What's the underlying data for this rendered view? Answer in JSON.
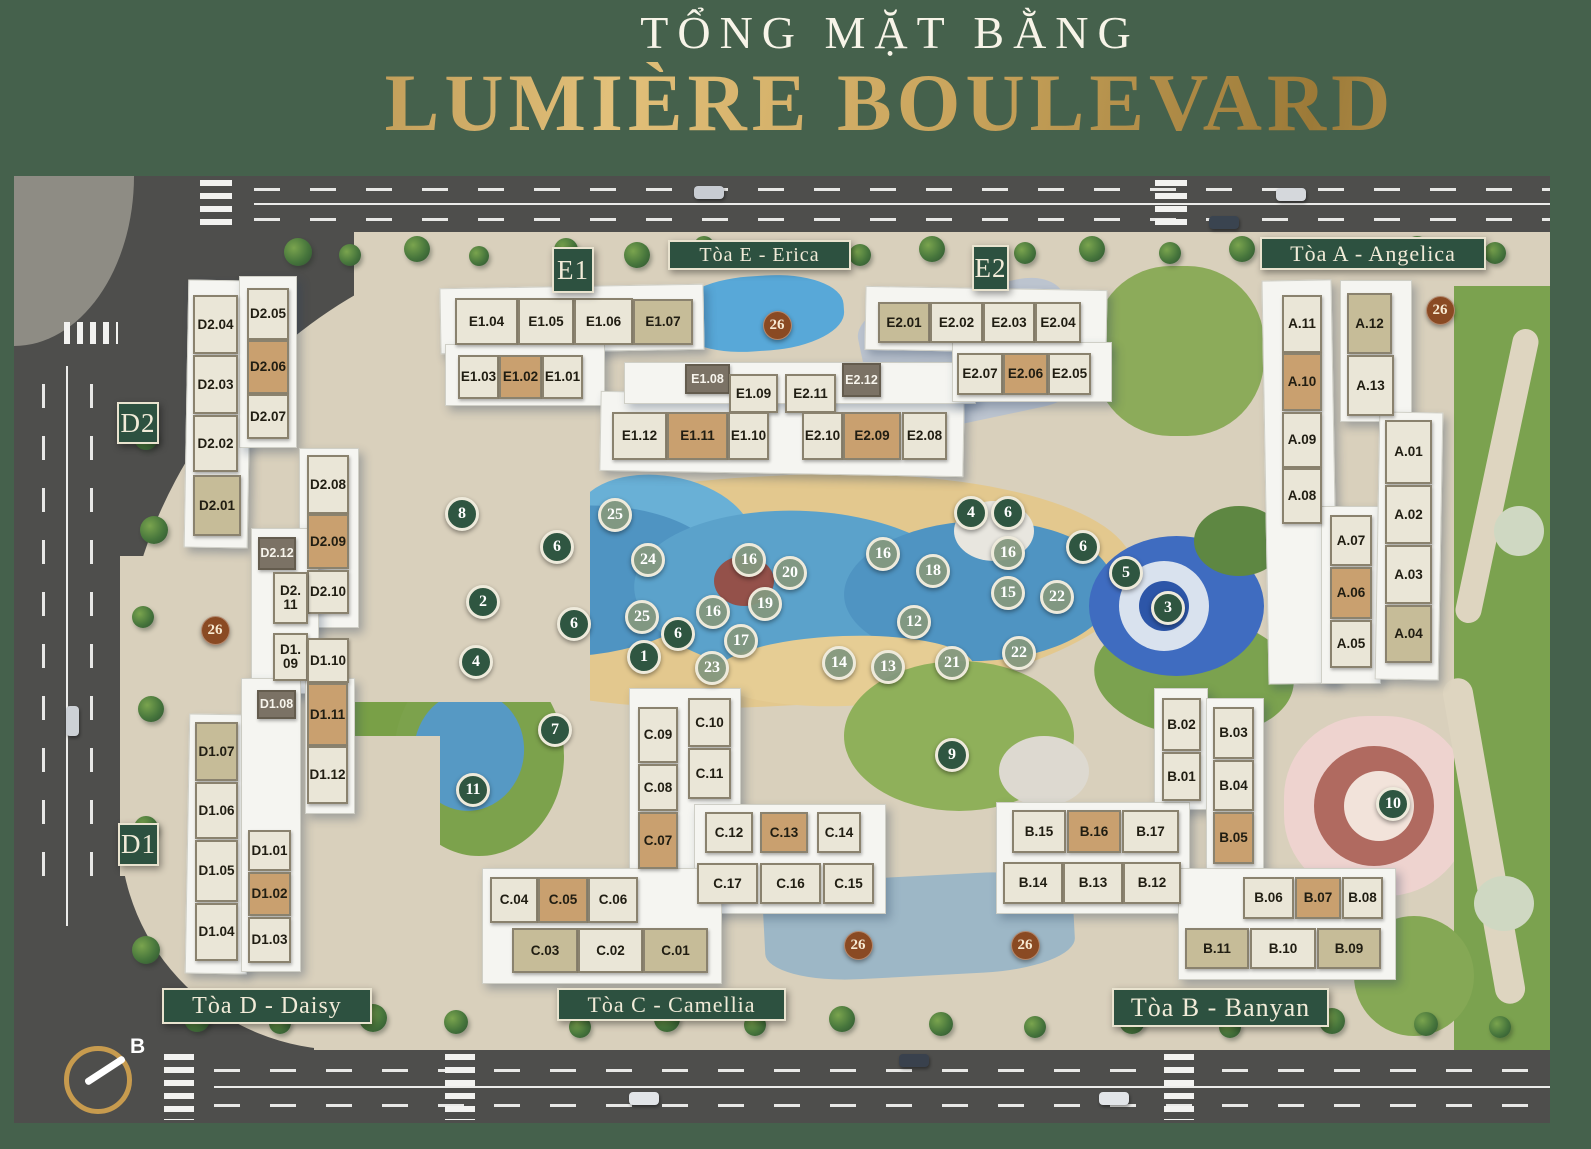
{
  "title": {
    "subtitle": "TỔNG MẶT BẰNG",
    "main": "LUMIÈRE BOULEVARD"
  },
  "colors": {
    "page_bg": "#45614c",
    "banner_green": "#2d5140",
    "gold": "#c9a45c",
    "unit_cream": "#eae6d7",
    "unit_tan": "#c9a06f",
    "unit_khaki": "#c6bc98",
    "unit_dark": "#7b7265",
    "marker_dark_green": "#2f5641",
    "marker_sage": "#84987e",
    "marker_brown": "#8a4a23"
  },
  "compass": {
    "label": "B"
  },
  "map": {
    "banners": [
      {
        "id": "banner-toa-e",
        "label": "Tòa E - Erica",
        "x": 668,
        "y": 240,
        "w": 183,
        "h": 30
      },
      {
        "id": "banner-toa-a",
        "label": "Tòa A - Angelica",
        "x": 1260,
        "y": 237,
        "w": 226,
        "h": 33
      },
      {
        "id": "banner-toa-d",
        "label": "Tòa D - Daisy",
        "x": 162,
        "y": 988,
        "w": 210,
        "h": 36
      },
      {
        "id": "banner-toa-c",
        "label": "Tòa C - Camellia",
        "x": 557,
        "y": 988,
        "w": 229,
        "h": 33
      },
      {
        "id": "banner-toa-b",
        "label": "Tòa B - Banyan",
        "x": 1112,
        "y": 988,
        "w": 217,
        "h": 39
      }
    ],
    "block_labels": [
      {
        "id": "block-label-e1",
        "label": "E1",
        "x": 552,
        "y": 247,
        "w": 42,
        "h": 46
      },
      {
        "id": "block-label-e2",
        "label": "E2",
        "x": 972,
        "y": 245,
        "w": 37,
        "h": 46
      },
      {
        "id": "block-label-d2",
        "label": "D2",
        "x": 117,
        "y": 402,
        "w": 42,
        "h": 42
      },
      {
        "id": "block-label-d1",
        "label": "D1",
        "x": 118,
        "y": 823,
        "w": 41,
        "h": 43
      }
    ],
    "units": [
      {
        "l": "E1.04",
        "x": 455,
        "y": 298,
        "w": 63,
        "h": 47,
        "t": "cream"
      },
      {
        "l": "E1.05",
        "x": 518,
        "y": 298,
        "w": 56,
        "h": 47,
        "t": "cream"
      },
      {
        "l": "E1.06",
        "x": 574,
        "y": 298,
        "w": 59,
        "h": 47,
        "t": "cream"
      },
      {
        "l": "E1.07",
        "x": 633,
        "y": 299,
        "w": 60,
        "h": 46,
        "t": "khaki"
      },
      {
        "l": "E1.03",
        "x": 458,
        "y": 355,
        "w": 41,
        "h": 44,
        "t": "cream"
      },
      {
        "l": "E1.02",
        "x": 499,
        "y": 355,
        "w": 43,
        "h": 44,
        "t": "tan"
      },
      {
        "l": "E1.01",
        "x": 542,
        "y": 355,
        "w": 41,
        "h": 44,
        "t": "cream"
      },
      {
        "l": "E1.08",
        "x": 685,
        "y": 364,
        "w": 45,
        "h": 30,
        "t": "dark"
      },
      {
        "l": "E1.09",
        "x": 729,
        "y": 374,
        "w": 49,
        "h": 39,
        "t": "cream"
      },
      {
        "l": "E2.11",
        "x": 785,
        "y": 374,
        "w": 51,
        "h": 39,
        "t": "cream"
      },
      {
        "l": "E2.12",
        "x": 842,
        "y": 363,
        "w": 39,
        "h": 34,
        "t": "dark"
      },
      {
        "l": "E1.12",
        "x": 612,
        "y": 412,
        "w": 55,
        "h": 48,
        "t": "cream"
      },
      {
        "l": "E1.11",
        "x": 667,
        "y": 412,
        "w": 61,
        "h": 48,
        "t": "tan"
      },
      {
        "l": "E1.10",
        "x": 728,
        "y": 412,
        "w": 41,
        "h": 48,
        "t": "cream"
      },
      {
        "l": "E2.10",
        "x": 802,
        "y": 412,
        "w": 41,
        "h": 48,
        "t": "cream"
      },
      {
        "l": "E2.09",
        "x": 843,
        "y": 412,
        "w": 58,
        "h": 48,
        "t": "tan"
      },
      {
        "l": "E2.08",
        "x": 902,
        "y": 412,
        "w": 45,
        "h": 48,
        "t": "cream"
      },
      {
        "l": "E2.01",
        "x": 878,
        "y": 302,
        "w": 52,
        "h": 41,
        "t": "khaki"
      },
      {
        "l": "E2.02",
        "x": 930,
        "y": 302,
        "w": 53,
        "h": 41,
        "t": "cream"
      },
      {
        "l": "E2.03",
        "x": 983,
        "y": 302,
        "w": 52,
        "h": 41,
        "t": "cream"
      },
      {
        "l": "E2.04",
        "x": 1035,
        "y": 302,
        "w": 46,
        "h": 41,
        "t": "cream"
      },
      {
        "l": "E2.07",
        "x": 957,
        "y": 353,
        "w": 46,
        "h": 42,
        "t": "cream"
      },
      {
        "l": "E2.06",
        "x": 1003,
        "y": 353,
        "w": 45,
        "h": 42,
        "t": "tan"
      },
      {
        "l": "E2.05",
        "x": 1048,
        "y": 353,
        "w": 43,
        "h": 42,
        "t": "cream"
      },
      {
        "l": "A.11",
        "x": 1282,
        "y": 295,
        "w": 40,
        "h": 58,
        "t": "cream"
      },
      {
        "l": "A.12",
        "x": 1347,
        "y": 293,
        "w": 45,
        "h": 61,
        "t": "khaki"
      },
      {
        "l": "A.10",
        "x": 1282,
        "y": 353,
        "w": 40,
        "h": 58,
        "t": "tan"
      },
      {
        "l": "A.13",
        "x": 1347,
        "y": 355,
        "w": 47,
        "h": 61,
        "t": "cream"
      },
      {
        "l": "A.09",
        "x": 1282,
        "y": 412,
        "w": 40,
        "h": 56,
        "t": "cream"
      },
      {
        "l": "A.08",
        "x": 1282,
        "y": 468,
        "w": 40,
        "h": 56,
        "t": "cream"
      },
      {
        "l": "A.01",
        "x": 1385,
        "y": 420,
        "w": 47,
        "h": 64,
        "t": "cream"
      },
      {
        "l": "A.02",
        "x": 1385,
        "y": 485,
        "w": 47,
        "h": 59,
        "t": "cream"
      },
      {
        "l": "A.03",
        "x": 1385,
        "y": 545,
        "w": 47,
        "h": 59,
        "t": "cream"
      },
      {
        "l": "A.04",
        "x": 1385,
        "y": 605,
        "w": 47,
        "h": 58,
        "t": "khaki"
      },
      {
        "l": "A.07",
        "x": 1330,
        "y": 515,
        "w": 42,
        "h": 51,
        "t": "cream"
      },
      {
        "l": "A.06",
        "x": 1330,
        "y": 567,
        "w": 42,
        "h": 52,
        "t": "tan"
      },
      {
        "l": "A.05",
        "x": 1330,
        "y": 620,
        "w": 42,
        "h": 48,
        "t": "cream"
      },
      {
        "l": "D2.04",
        "x": 193,
        "y": 295,
        "w": 45,
        "h": 59,
        "t": "cream"
      },
      {
        "l": "D2.03",
        "x": 193,
        "y": 355,
        "w": 45,
        "h": 59,
        "t": "cream"
      },
      {
        "l": "D2.02",
        "x": 193,
        "y": 415,
        "w": 45,
        "h": 57,
        "t": "cream"
      },
      {
        "l": "D2.01",
        "x": 193,
        "y": 475,
        "w": 48,
        "h": 61,
        "t": "khaki"
      },
      {
        "l": "D2.05",
        "x": 247,
        "y": 288,
        "w": 42,
        "h": 52,
        "t": "cream"
      },
      {
        "l": "D2.06",
        "x": 247,
        "y": 340,
        "w": 42,
        "h": 54,
        "t": "tan"
      },
      {
        "l": "D2.07",
        "x": 247,
        "y": 394,
        "w": 42,
        "h": 45,
        "t": "cream"
      },
      {
        "l": "D2.08",
        "x": 307,
        "y": 455,
        "w": 42,
        "h": 59,
        "t": "cream"
      },
      {
        "l": "D2.09",
        "x": 307,
        "y": 514,
        "w": 42,
        "h": 55,
        "t": "tan"
      },
      {
        "l": "D2.10",
        "x": 307,
        "y": 570,
        "w": 42,
        "h": 44,
        "t": "cream"
      },
      {
        "l": "D2.12",
        "x": 258,
        "y": 537,
        "w": 38,
        "h": 33,
        "t": "dark"
      },
      {
        "l": "D2.11",
        "x": 273,
        "y": 572,
        "w": 35,
        "h": 52,
        "t": "cream",
        "lines": [
          "D2.",
          "11"
        ]
      },
      {
        "l": "D1.09",
        "x": 273,
        "y": 633,
        "w": 35,
        "h": 48,
        "t": "cream",
        "lines": [
          "D1.",
          "09"
        ]
      },
      {
        "l": "D1.10",
        "x": 307,
        "y": 638,
        "w": 42,
        "h": 45,
        "t": "cream"
      },
      {
        "l": "D1.08",
        "x": 257,
        "y": 690,
        "w": 39,
        "h": 29,
        "t": "dark"
      },
      {
        "l": "D1.11",
        "x": 307,
        "y": 683,
        "w": 41,
        "h": 63,
        "t": "tan"
      },
      {
        "l": "D1.12",
        "x": 307,
        "y": 746,
        "w": 41,
        "h": 58,
        "t": "cream"
      },
      {
        "l": "D1.07",
        "x": 195,
        "y": 722,
        "w": 43,
        "h": 59,
        "t": "khaki"
      },
      {
        "l": "D1.06",
        "x": 195,
        "y": 782,
        "w": 43,
        "h": 57,
        "t": "cream"
      },
      {
        "l": "D1.05",
        "x": 195,
        "y": 840,
        "w": 43,
        "h": 62,
        "t": "cream"
      },
      {
        "l": "D1.04",
        "x": 195,
        "y": 903,
        "w": 43,
        "h": 58,
        "t": "cream"
      },
      {
        "l": "D1.01",
        "x": 248,
        "y": 830,
        "w": 43,
        "h": 41,
        "t": "cream"
      },
      {
        "l": "D1.02",
        "x": 248,
        "y": 872,
        "w": 43,
        "h": 44,
        "t": "tan"
      },
      {
        "l": "D1.03",
        "x": 248,
        "y": 917,
        "w": 43,
        "h": 46,
        "t": "cream"
      },
      {
        "l": "C.09",
        "x": 638,
        "y": 707,
        "w": 40,
        "h": 56,
        "t": "cream"
      },
      {
        "l": "C.08",
        "x": 638,
        "y": 764,
        "w": 40,
        "h": 47,
        "t": "cream"
      },
      {
        "l": "C.07",
        "x": 638,
        "y": 812,
        "w": 40,
        "h": 57,
        "t": "tan"
      },
      {
        "l": "C.10",
        "x": 688,
        "y": 698,
        "w": 43,
        "h": 49,
        "t": "cream"
      },
      {
        "l": "C.11",
        "x": 688,
        "y": 748,
        "w": 43,
        "h": 51,
        "t": "cream"
      },
      {
        "l": "C.12",
        "x": 705,
        "y": 812,
        "w": 48,
        "h": 41,
        "t": "cream"
      },
      {
        "l": "C.13",
        "x": 760,
        "y": 812,
        "w": 48,
        "h": 41,
        "t": "tan"
      },
      {
        "l": "C.14",
        "x": 817,
        "y": 812,
        "w": 44,
        "h": 41,
        "t": "cream"
      },
      {
        "l": "C.17",
        "x": 697,
        "y": 863,
        "w": 61,
        "h": 41,
        "t": "cream"
      },
      {
        "l": "C.16",
        "x": 760,
        "y": 863,
        "w": 61,
        "h": 41,
        "t": "cream"
      },
      {
        "l": "C.15",
        "x": 823,
        "y": 863,
        "w": 51,
        "h": 41,
        "t": "cream"
      },
      {
        "l": "C.04",
        "x": 490,
        "y": 877,
        "w": 48,
        "h": 46,
        "t": "cream"
      },
      {
        "l": "C.05",
        "x": 538,
        "y": 877,
        "w": 50,
        "h": 46,
        "t": "tan"
      },
      {
        "l": "C.06",
        "x": 588,
        "y": 877,
        "w": 50,
        "h": 46,
        "t": "cream"
      },
      {
        "l": "C.03",
        "x": 512,
        "y": 928,
        "w": 66,
        "h": 45,
        "t": "khaki"
      },
      {
        "l": "C.02",
        "x": 578,
        "y": 928,
        "w": 65,
        "h": 45,
        "t": "cream"
      },
      {
        "l": "C.01",
        "x": 643,
        "y": 928,
        "w": 65,
        "h": 45,
        "t": "khaki"
      },
      {
        "l": "B.02",
        "x": 1162,
        "y": 698,
        "w": 39,
        "h": 53,
        "t": "cream"
      },
      {
        "l": "B.01",
        "x": 1162,
        "y": 752,
        "w": 39,
        "h": 49,
        "t": "cream"
      },
      {
        "l": "B.03",
        "x": 1213,
        "y": 707,
        "w": 41,
        "h": 52,
        "t": "cream"
      },
      {
        "l": "B.04",
        "x": 1213,
        "y": 760,
        "w": 41,
        "h": 51,
        "t": "cream"
      },
      {
        "l": "B.05",
        "x": 1213,
        "y": 812,
        "w": 41,
        "h": 52,
        "t": "tan"
      },
      {
        "l": "B.15",
        "x": 1012,
        "y": 810,
        "w": 54,
        "h": 43,
        "t": "cream"
      },
      {
        "l": "B.16",
        "x": 1067,
        "y": 810,
        "w": 54,
        "h": 43,
        "t": "tan"
      },
      {
        "l": "B.17",
        "x": 1122,
        "y": 810,
        "w": 57,
        "h": 43,
        "t": "cream"
      },
      {
        "l": "B.14",
        "x": 1003,
        "y": 862,
        "w": 60,
        "h": 42,
        "t": "cream"
      },
      {
        "l": "B.13",
        "x": 1063,
        "y": 862,
        "w": 60,
        "h": 42,
        "t": "cream"
      },
      {
        "l": "B.12",
        "x": 1123,
        "y": 862,
        "w": 58,
        "h": 42,
        "t": "cream"
      },
      {
        "l": "B.06",
        "x": 1243,
        "y": 877,
        "w": 51,
        "h": 42,
        "t": "cream"
      },
      {
        "l": "B.07",
        "x": 1295,
        "y": 877,
        "w": 46,
        "h": 42,
        "t": "tan"
      },
      {
        "l": "B.08",
        "x": 1342,
        "y": 877,
        "w": 41,
        "h": 42,
        "t": "cream"
      },
      {
        "l": "B.11",
        "x": 1185,
        "y": 928,
        "w": 64,
        "h": 41,
        "t": "khaki"
      },
      {
        "l": "B.10",
        "x": 1250,
        "y": 928,
        "w": 66,
        "h": 41,
        "t": "cream"
      },
      {
        "l": "B.09",
        "x": 1317,
        "y": 928,
        "w": 64,
        "h": 41,
        "t": "khaki"
      }
    ],
    "markers": [
      {
        "n": "8",
        "x": 462,
        "y": 514,
        "s": "dark"
      },
      {
        "n": "6",
        "x": 557,
        "y": 547,
        "s": "dark"
      },
      {
        "n": "2",
        "x": 483,
        "y": 602,
        "s": "dark"
      },
      {
        "n": "6",
        "x": 574,
        "y": 624,
        "s": "dark"
      },
      {
        "n": "6",
        "x": 678,
        "y": 634,
        "s": "dark"
      },
      {
        "n": "1",
        "x": 644,
        "y": 657,
        "s": "dark"
      },
      {
        "n": "4",
        "x": 476,
        "y": 662,
        "s": "dark"
      },
      {
        "n": "7",
        "x": 555,
        "y": 730,
        "s": "dark"
      },
      {
        "n": "11",
        "x": 473,
        "y": 790,
        "s": "dark"
      },
      {
        "n": "4",
        "x": 971,
        "y": 513,
        "s": "dark"
      },
      {
        "n": "6",
        "x": 1008,
        "y": 513,
        "s": "dark"
      },
      {
        "n": "6",
        "x": 1083,
        "y": 547,
        "s": "dark"
      },
      {
        "n": "5",
        "x": 1126,
        "y": 573,
        "s": "dark"
      },
      {
        "n": "3",
        "x": 1168,
        "y": 608,
        "s": "dark"
      },
      {
        "n": "9",
        "x": 952,
        "y": 755,
        "s": "dark"
      },
      {
        "n": "10",
        "x": 1393,
        "y": 804,
        "s": "dark"
      },
      {
        "n": "25",
        "x": 615,
        "y": 515,
        "s": "sage"
      },
      {
        "n": "24",
        "x": 648,
        "y": 560,
        "s": "sage"
      },
      {
        "n": "16",
        "x": 749,
        "y": 560,
        "s": "sage"
      },
      {
        "n": "20",
        "x": 790,
        "y": 573,
        "s": "sage"
      },
      {
        "n": "19",
        "x": 765,
        "y": 604,
        "s": "sage"
      },
      {
        "n": "16",
        "x": 713,
        "y": 612,
        "s": "sage"
      },
      {
        "n": "25",
        "x": 642,
        "y": 617,
        "s": "sage"
      },
      {
        "n": "17",
        "x": 741,
        "y": 641,
        "s": "sage"
      },
      {
        "n": "23",
        "x": 712,
        "y": 668,
        "s": "sage"
      },
      {
        "n": "16",
        "x": 883,
        "y": 554,
        "s": "sage"
      },
      {
        "n": "18",
        "x": 933,
        "y": 571,
        "s": "sage"
      },
      {
        "n": "16",
        "x": 1008,
        "y": 553,
        "s": "sage"
      },
      {
        "n": "15",
        "x": 1008,
        "y": 593,
        "s": "sage"
      },
      {
        "n": "22",
        "x": 1057,
        "y": 597,
        "s": "sage"
      },
      {
        "n": "12",
        "x": 914,
        "y": 622,
        "s": "sage"
      },
      {
        "n": "14",
        "x": 839,
        "y": 663,
        "s": "sage"
      },
      {
        "n": "13",
        "x": 888,
        "y": 667,
        "s": "sage"
      },
      {
        "n": "21",
        "x": 952,
        "y": 663,
        "s": "sage"
      },
      {
        "n": "22",
        "x": 1019,
        "y": 653,
        "s": "sage"
      },
      {
        "n": "26",
        "x": 777,
        "y": 325,
        "s": "brown"
      },
      {
        "n": "26",
        "x": 1440,
        "y": 310,
        "s": "brown"
      },
      {
        "n": "26",
        "x": 215,
        "y": 630,
        "s": "brown"
      },
      {
        "n": "26",
        "x": 858,
        "y": 945,
        "s": "brown"
      },
      {
        "n": "26",
        "x": 1025,
        "y": 945,
        "s": "brown"
      }
    ]
  }
}
